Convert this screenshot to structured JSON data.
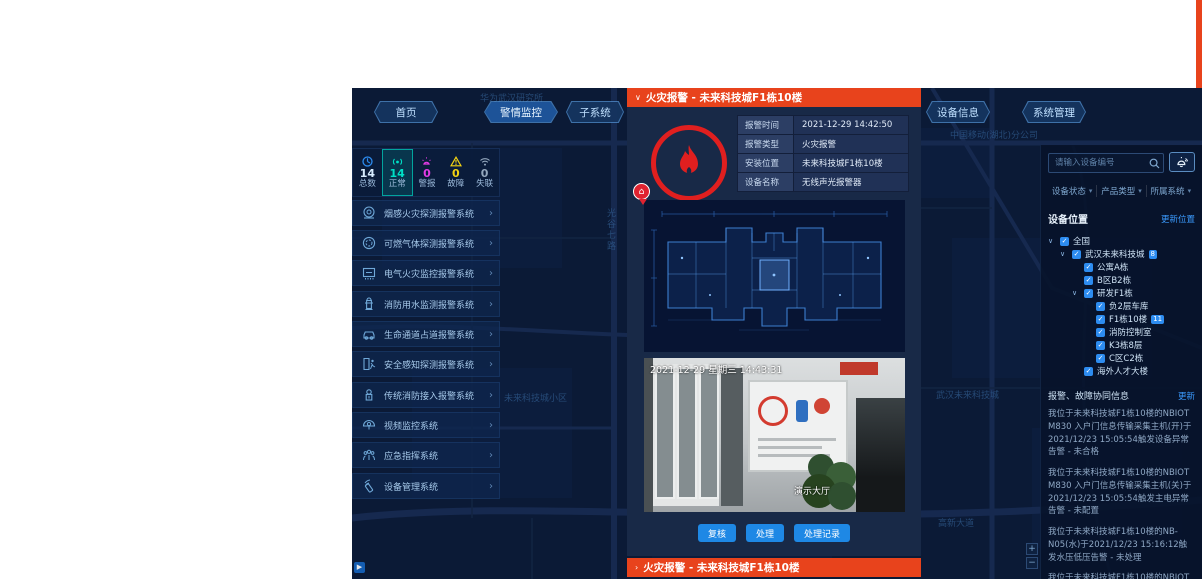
{
  "colors": {
    "alert_red": "#e8431c",
    "accent_blue": "#1e88e5",
    "link_blue": "#3b9bff",
    "teal": "#00e0c6",
    "magenta": "#e53ce5",
    "yellow": "#f5d312",
    "gray": "#93a7bd"
  },
  "top_nav": {
    "home": "首页",
    "alarm_monitor": "警情监控",
    "subsystems": "子系统",
    "device_info": "设备信息",
    "system_mgmt": "系统管理"
  },
  "stats": {
    "items": [
      {
        "label": "总数",
        "value": "14"
      },
      {
        "label": "正常",
        "value": "14"
      },
      {
        "label": "警报",
        "value": "0"
      },
      {
        "label": "故障",
        "value": "0"
      },
      {
        "label": "失联",
        "value": "0"
      }
    ]
  },
  "sidebar": {
    "chevron": "›",
    "menu": [
      {
        "label": "烟感火灾探测报警系统"
      },
      {
        "label": "可燃气体探测报警系统"
      },
      {
        "label": "电气火灾监控报警系统"
      },
      {
        "label": "消防用水监测报警系统"
      },
      {
        "label": "生命通道占道报警系统"
      },
      {
        "label": "安全感知探测报警系统"
      },
      {
        "label": "传统消防接入报警系统"
      },
      {
        "label": "视频监控系统"
      },
      {
        "label": "应急指挥系统"
      },
      {
        "label": "设备管理系统"
      }
    ]
  },
  "alarm_modal": {
    "collapse_icon": "∨",
    "title": "火灾报警 - 未来科技城F1栋10楼",
    "info_rows": [
      {
        "label": "报警时间",
        "value": "2021-12-29 14:42:50"
      },
      {
        "label": "报警类型",
        "value": "火灾报警"
      },
      {
        "label": "安装位置",
        "value": "未来科技城F1栋10楼"
      },
      {
        "label": "设备名称",
        "value": "无线声光报警器"
      }
    ],
    "camera": {
      "timestamp": "2021-12-29 星期三 14:43:31",
      "watermark": "演示大厅"
    },
    "actions": [
      {
        "label": "复核"
      },
      {
        "label": "处理"
      },
      {
        "label": "处理记录"
      }
    ]
  },
  "alarm_bar": {
    "expand_icon": "›",
    "title": "火灾报警 - 未来科技城F1栋10楼"
  },
  "right_panel": {
    "search_placeholder": "请输入设备编号",
    "caret": "▾",
    "filters": [
      {
        "label": "设备状态"
      },
      {
        "label": "产品类型"
      },
      {
        "label": "所属系统"
      }
    ],
    "location_title": "设备位置",
    "location_action": "更新位置",
    "tree": [
      {
        "label": "全国",
        "level": 0,
        "caret": true,
        "checked": true
      },
      {
        "label": "武汉未来科技城",
        "level": 1,
        "caret": true,
        "checked": true,
        "badge": "8"
      },
      {
        "label": "公寓A栋",
        "level": 2,
        "checked": true
      },
      {
        "label": "B区B2栋",
        "level": 2,
        "checked": true
      },
      {
        "label": "研发F1栋",
        "level": 2,
        "caret": true,
        "checked": true
      },
      {
        "label": "负2层车库",
        "level": 3,
        "checked": true
      },
      {
        "label": "F1栋10楼",
        "level": 3,
        "checked": true,
        "badge": "11"
      },
      {
        "label": "消防控制室",
        "level": 3,
        "checked": true
      },
      {
        "label": "K3栋8层",
        "level": 3,
        "checked": true
      },
      {
        "label": "C区C2栋",
        "level": 3,
        "checked": true
      },
      {
        "label": "海外人才大楼",
        "level": 2,
        "checked": true
      }
    ],
    "alerts_title": "报警、故障协同信息",
    "alerts_action": "更新",
    "messages": [
      {
        "text": "我位于未来科技城F1栋10楼的NBIOT M830 入户门信息传输采集主机(开)于2021/12/23 15:05:54触发设备异常告警 - 未合格"
      },
      {
        "text": "我位于未来科技城F1栋10楼的NBIOT M830 入户门信息传输采集主机(关)于2021/12/23 15:05:54触发主电异常告警 - 未配置"
      },
      {
        "text": "我位于未来科技城F1栋10楼的NB-N05(水)于2021/12/23 15:16:12触发水压低压告警 - 未处理"
      },
      {
        "text": "我位于未来科技城F1栋10楼的NBIOT M830 入户门信息"
      }
    ]
  },
  "map": {
    "labels": [
      {
        "text": "华为武汉研究所"
      },
      {
        "text": "中国移动(湖北)分公司"
      },
      {
        "text": "光谷七路"
      },
      {
        "text": "未来科技城小区"
      },
      {
        "text": "高新大道"
      },
      {
        "text": "武汉未来科技城"
      }
    ]
  },
  "checkmark": "✓"
}
